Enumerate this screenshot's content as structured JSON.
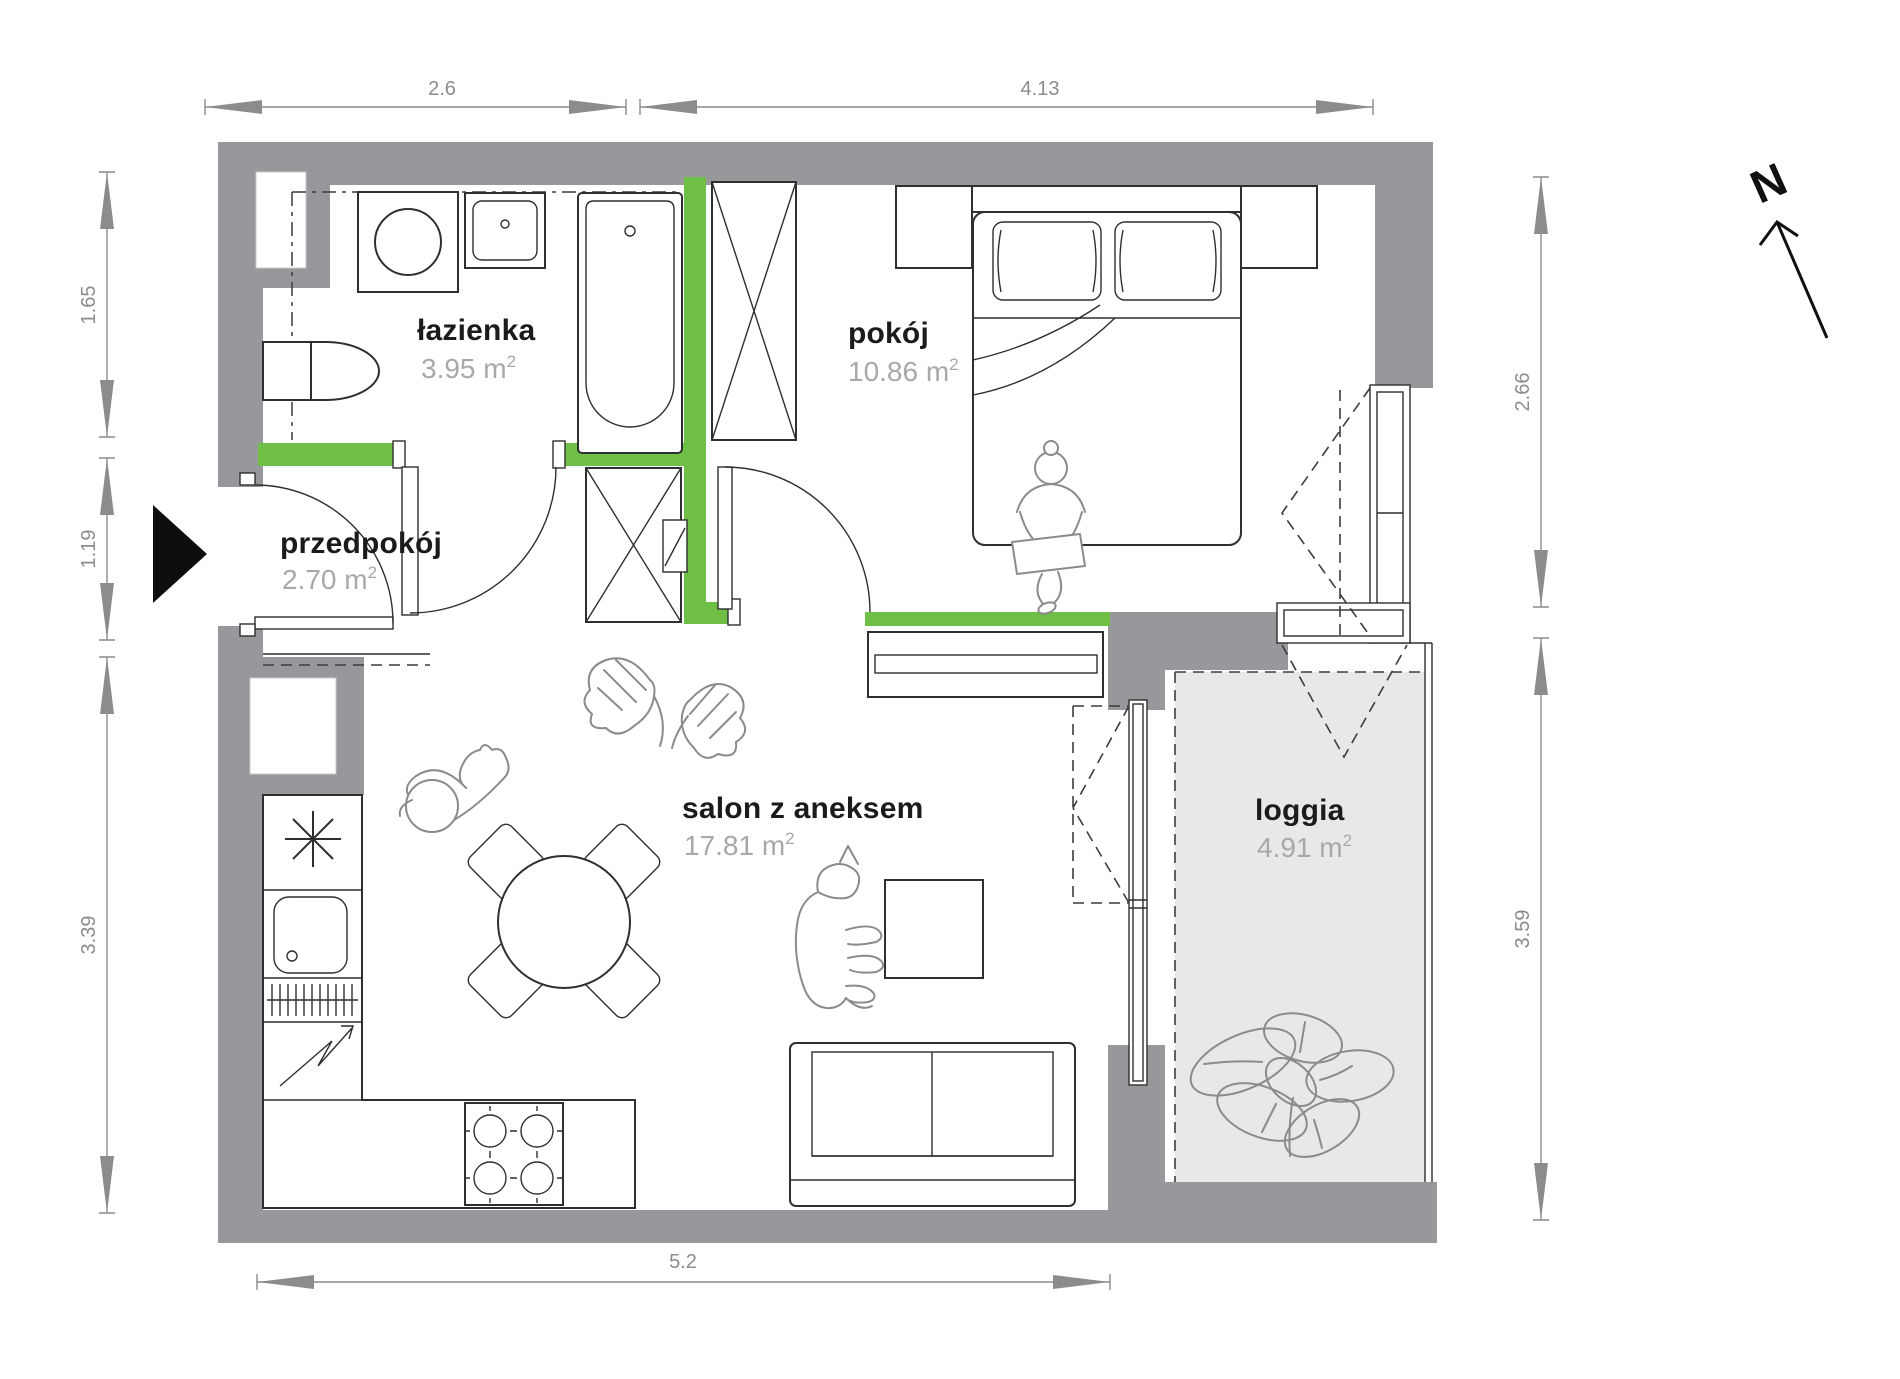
{
  "plan": {
    "north_label": "N",
    "rooms": [
      {
        "name": "łazienka",
        "area": "3.95 m",
        "sup": "2"
      },
      {
        "name": "pokój",
        "area": "10.86 m",
        "sup": "2"
      },
      {
        "name": "przedpokój",
        "area": "2.70 m",
        "sup": "2"
      },
      {
        "name": "salon z aneksem",
        "area": "17.81 m",
        "sup": "2"
      },
      {
        "name": "loggia",
        "area": "4.91 m",
        "sup": "2"
      }
    ],
    "dims": {
      "top": [
        "2.6",
        "4.13"
      ],
      "left": [
        "1.65",
        "1.19",
        "3.39"
      ],
      "right": [
        "2.66",
        "3.59"
      ],
      "bottom": [
        "5.2"
      ]
    },
    "colors": {
      "wall": "#97989b",
      "green": "#6fbe45",
      "loggia": "#e8e8e8",
      "line": "#2f2f2f",
      "figure": "#8b8b8b",
      "dim": "#8c8c8c",
      "name": "#1b1b1d",
      "area": "#a8a8a8"
    }
  }
}
